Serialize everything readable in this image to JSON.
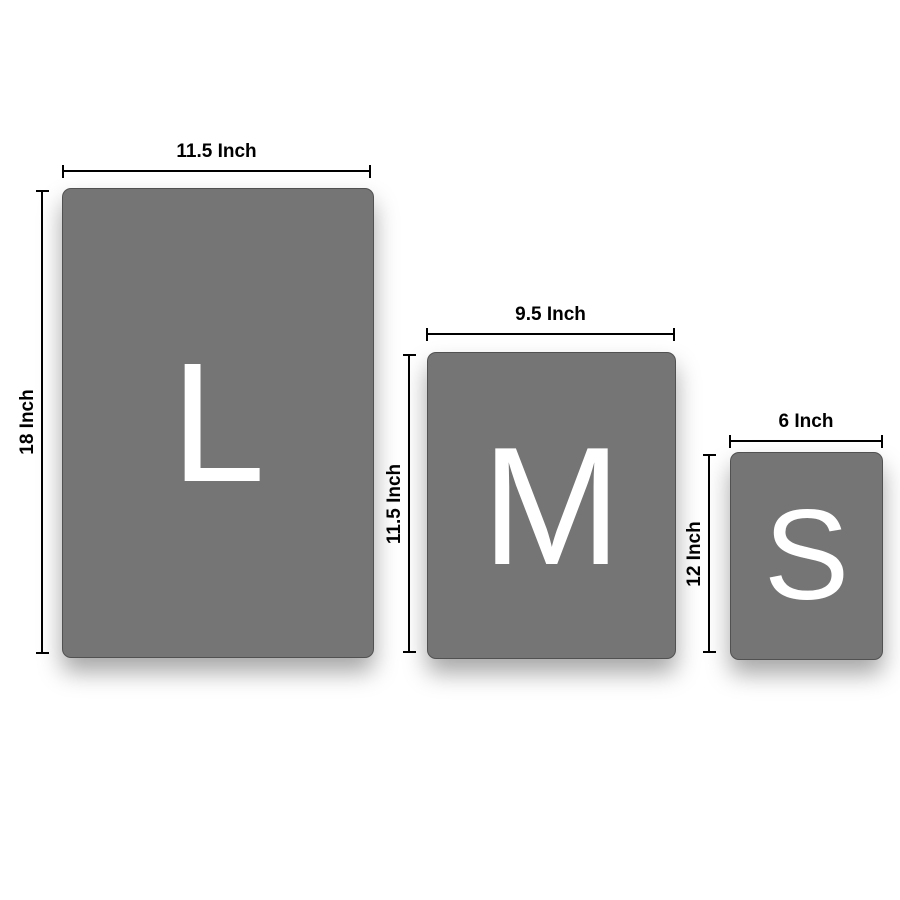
{
  "diagram": {
    "type": "size-chart",
    "background_color": "#ffffff",
    "panel_color": "#757575",
    "letter_color": "#ffffff",
    "dimension_color": "#000000"
  },
  "sizes": [
    {
      "id": "large",
      "letter": "L",
      "width_label": "11.5 Inch",
      "height_label": "18 Inch"
    },
    {
      "id": "medium",
      "letter": "M",
      "width_label": "9.5 Inch",
      "height_label": "11.5 Inch"
    },
    {
      "id": "small",
      "letter": "S",
      "width_label": "6 Inch",
      "height_label": "12 Inch"
    }
  ]
}
